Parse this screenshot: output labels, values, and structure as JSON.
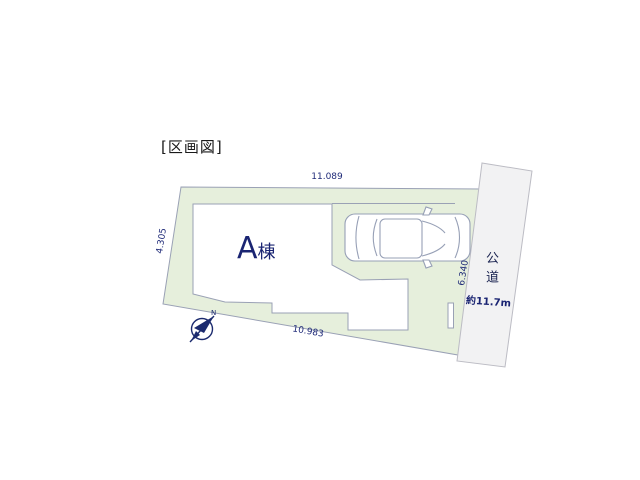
{
  "page": {
    "title": "[区画図]"
  },
  "plot": {
    "dim_top": "11.089",
    "dim_left": "4.305",
    "dim_right": "6.340",
    "dim_bottom": "10.983"
  },
  "building": {
    "name": "A",
    "suffix": "棟"
  },
  "road": {
    "label": "公道",
    "width": "約11.7m"
  },
  "compass": {
    "north": "N"
  },
  "colors": {
    "plot_fill": "#e6efdc",
    "plot_border": "#9aa1b5",
    "road_fill": "#f2f2f3",
    "building_fill": "#ffffff",
    "text_navy": "#1a2472",
    "compass_navy": "#1b2a6e"
  }
}
